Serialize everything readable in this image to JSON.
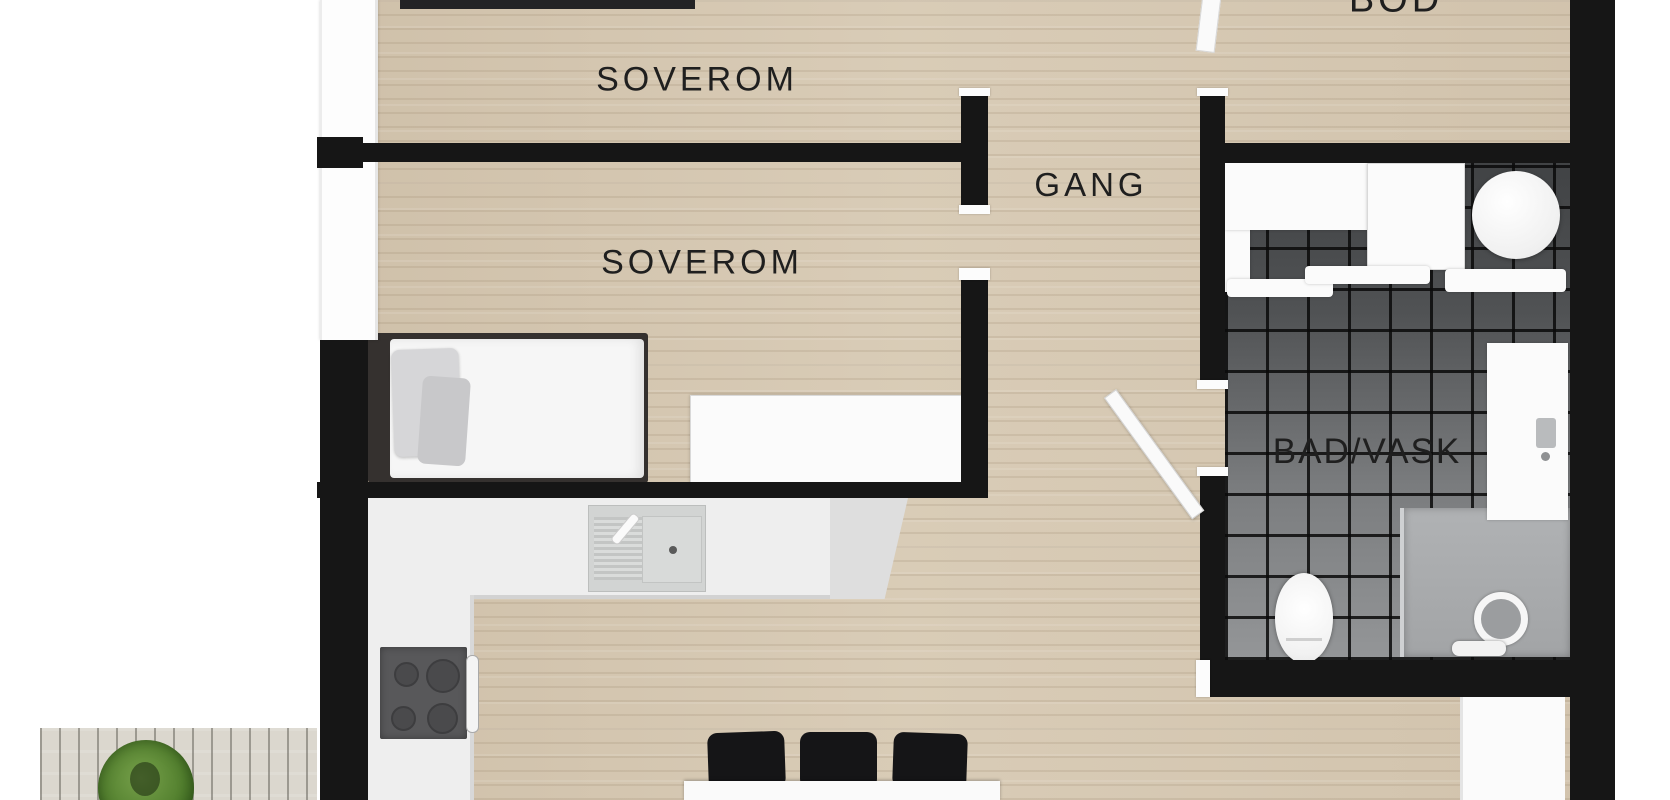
{
  "plan": {
    "labels": {
      "bedroom1": "SOVEROM",
      "bedroom2": "SOVEROM",
      "hallway": "GANG",
      "storage": "BOD",
      "bathroom": "BAD/VASK"
    },
    "colors": {
      "wall": "#161616",
      "wood_floor": "#d8cbb6",
      "tile_dark": "#4b4d4f",
      "tile_light": "#949698",
      "deck": "#dbd7ce",
      "plant_green": "#4e7a2b",
      "label_text": "#1f1f1f",
      "fixture_white": "#fbfbfb"
    }
  }
}
